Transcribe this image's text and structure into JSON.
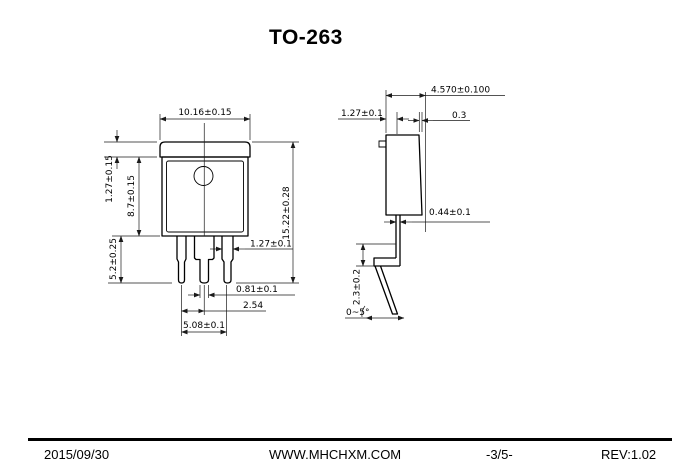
{
  "title": "TO-263",
  "front_view": {
    "dim_width": "10.16±0.15",
    "dim_tab_height": "1.27±0.15",
    "dim_body_height": "8.7±0.15",
    "dim_lead_length": "5.2±0.25",
    "dim_overall_height": "15.22±0.28",
    "dim_lead_width": "1.27±0.1",
    "dim_lead_tip_width": "0.81±0.1",
    "dim_lead_pitch": "2.54",
    "dim_lead_span": "5.08±0.1"
  },
  "side_view": {
    "dim_overall_thickness": "4.570±0.100",
    "dim_tab_thickness": "1.27±0.1",
    "dim_step": "0.3",
    "dim_lead_thickness": "0.44±0.1",
    "dim_foot_height": "2.3±0.2",
    "dim_lead_angle": "0~5°"
  },
  "footer": {
    "date": "2015/09/30",
    "website": "WWW.MHCHXM.COM",
    "page": "-3/5-",
    "revision": "REV:1.02"
  }
}
